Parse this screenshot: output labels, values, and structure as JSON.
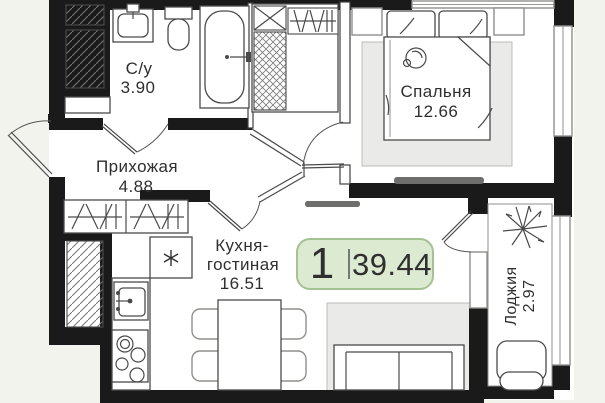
{
  "page": {
    "background": "#f3f3ee"
  },
  "plan": {
    "title_badge": {
      "rooms_count": "1",
      "total_area": "39.44",
      "fill": "#dcead1",
      "stroke": "#a3c394"
    },
    "rooms": {
      "bathroom": {
        "label": "С/у",
        "area": "3.90"
      },
      "hallway": {
        "label": "Прихожая",
        "area": "4.88"
      },
      "bedroom": {
        "label": "Спальня",
        "area": "12.66"
      },
      "kitchen_living": {
        "label_line1": "Кухня-",
        "label_line2": "гостиная",
        "area": "16.51"
      },
      "loggia": {
        "label": "Лоджия",
        "area": "2.97"
      }
    },
    "fixtures": [
      "entrance-door",
      "bathroom-door",
      "bedroom-door",
      "kitchen-doorway",
      "balcony-door",
      "ventilation-shaft",
      "bath-sink",
      "toilet",
      "bathtub",
      "closet-shelves",
      "closet-rail",
      "hall-wardrobe",
      "bed",
      "pillows",
      "nightstands",
      "sleeping-cat",
      "bedroom-rug",
      "bedroom-tv",
      "bedroom-window",
      "living-tv",
      "fridge",
      "kitchen-sink",
      "stove",
      "kitchen-counter",
      "dining-table",
      "chairs",
      "sofa",
      "living-rug",
      "loggia-plant",
      "loggia-armchair",
      "loggia-glazing"
    ],
    "colors": {
      "background": "#f3f3ee",
      "room_fill": "#ffffff",
      "wall": "#1a1a1a",
      "rug": "#eaeae8",
      "tv": "#6e6e6c",
      "badge_fill": "#dcead1",
      "badge_stroke": "#a3c394",
      "text": "#2f2f2f"
    }
  }
}
